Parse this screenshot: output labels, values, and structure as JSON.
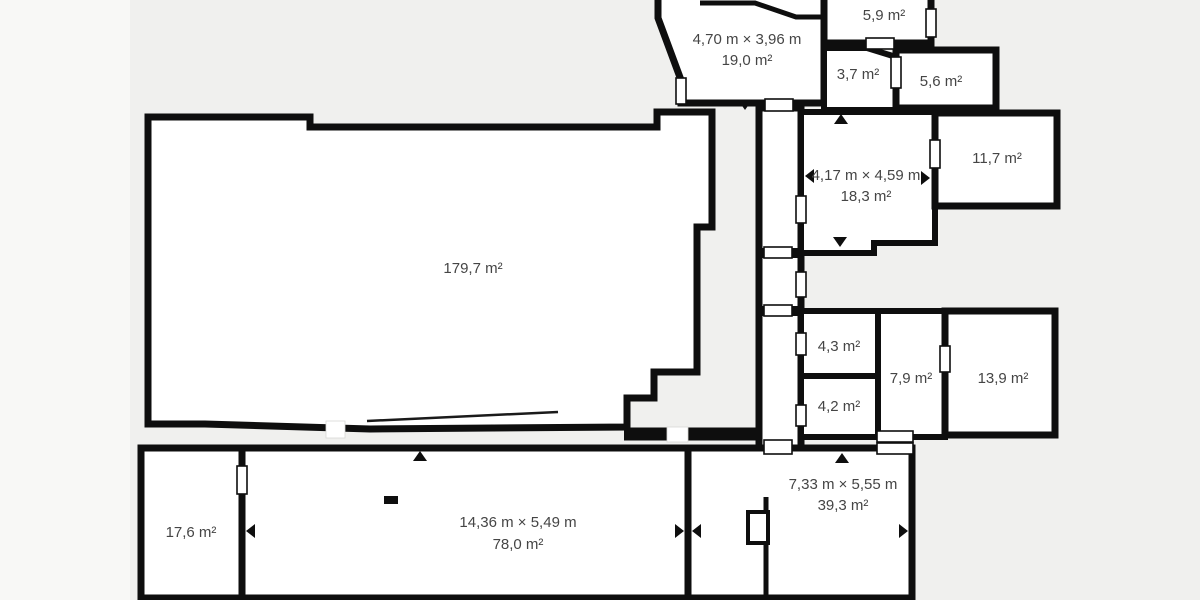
{
  "plan": {
    "unit": "m²",
    "colors": {
      "background": "#f0f0ee",
      "left_margin": "#f8f8f6",
      "wall": "#0e0e0e",
      "room_fill": "#ffffff",
      "highlight_fill": "#d9e7f8",
      "label_text": "#454545"
    },
    "rooms": [
      {
        "name": "living-room",
        "area_label": "179,7 m²"
      },
      {
        "name": "room-19-0",
        "size_label": "4,70 m × 3,96 m",
        "area_label": "19,0 m²"
      },
      {
        "name": "room-5-9",
        "area_label": "5,9 m²"
      },
      {
        "name": "room-3-7",
        "area_label": "3,7 m²"
      },
      {
        "name": "room-5-6",
        "area_label": "5,6 m²"
      },
      {
        "name": "room-18-3",
        "size_label": "4,17 m × 4,59 m",
        "area_label": "18,3 m²"
      },
      {
        "name": "room-11-7",
        "area_label": "11,7 m²"
      },
      {
        "name": "room-4-3",
        "area_label": "4,3 m²"
      },
      {
        "name": "room-4-2",
        "area_label": "4,2 m²"
      },
      {
        "name": "room-7-9",
        "area_label": "7,9 m²"
      },
      {
        "name": "room-13-9",
        "area_label": "13,9 m²"
      },
      {
        "name": "room-17-6",
        "area_label": "17,6 m²"
      },
      {
        "name": "room-78-0",
        "size_label": "14,36 m × 5,49 m",
        "area_label": "78,0 m²"
      },
      {
        "name": "room-39-3",
        "size_label": "7,33 m × 5,55 m",
        "area_label": "39,3 m²"
      }
    ]
  }
}
